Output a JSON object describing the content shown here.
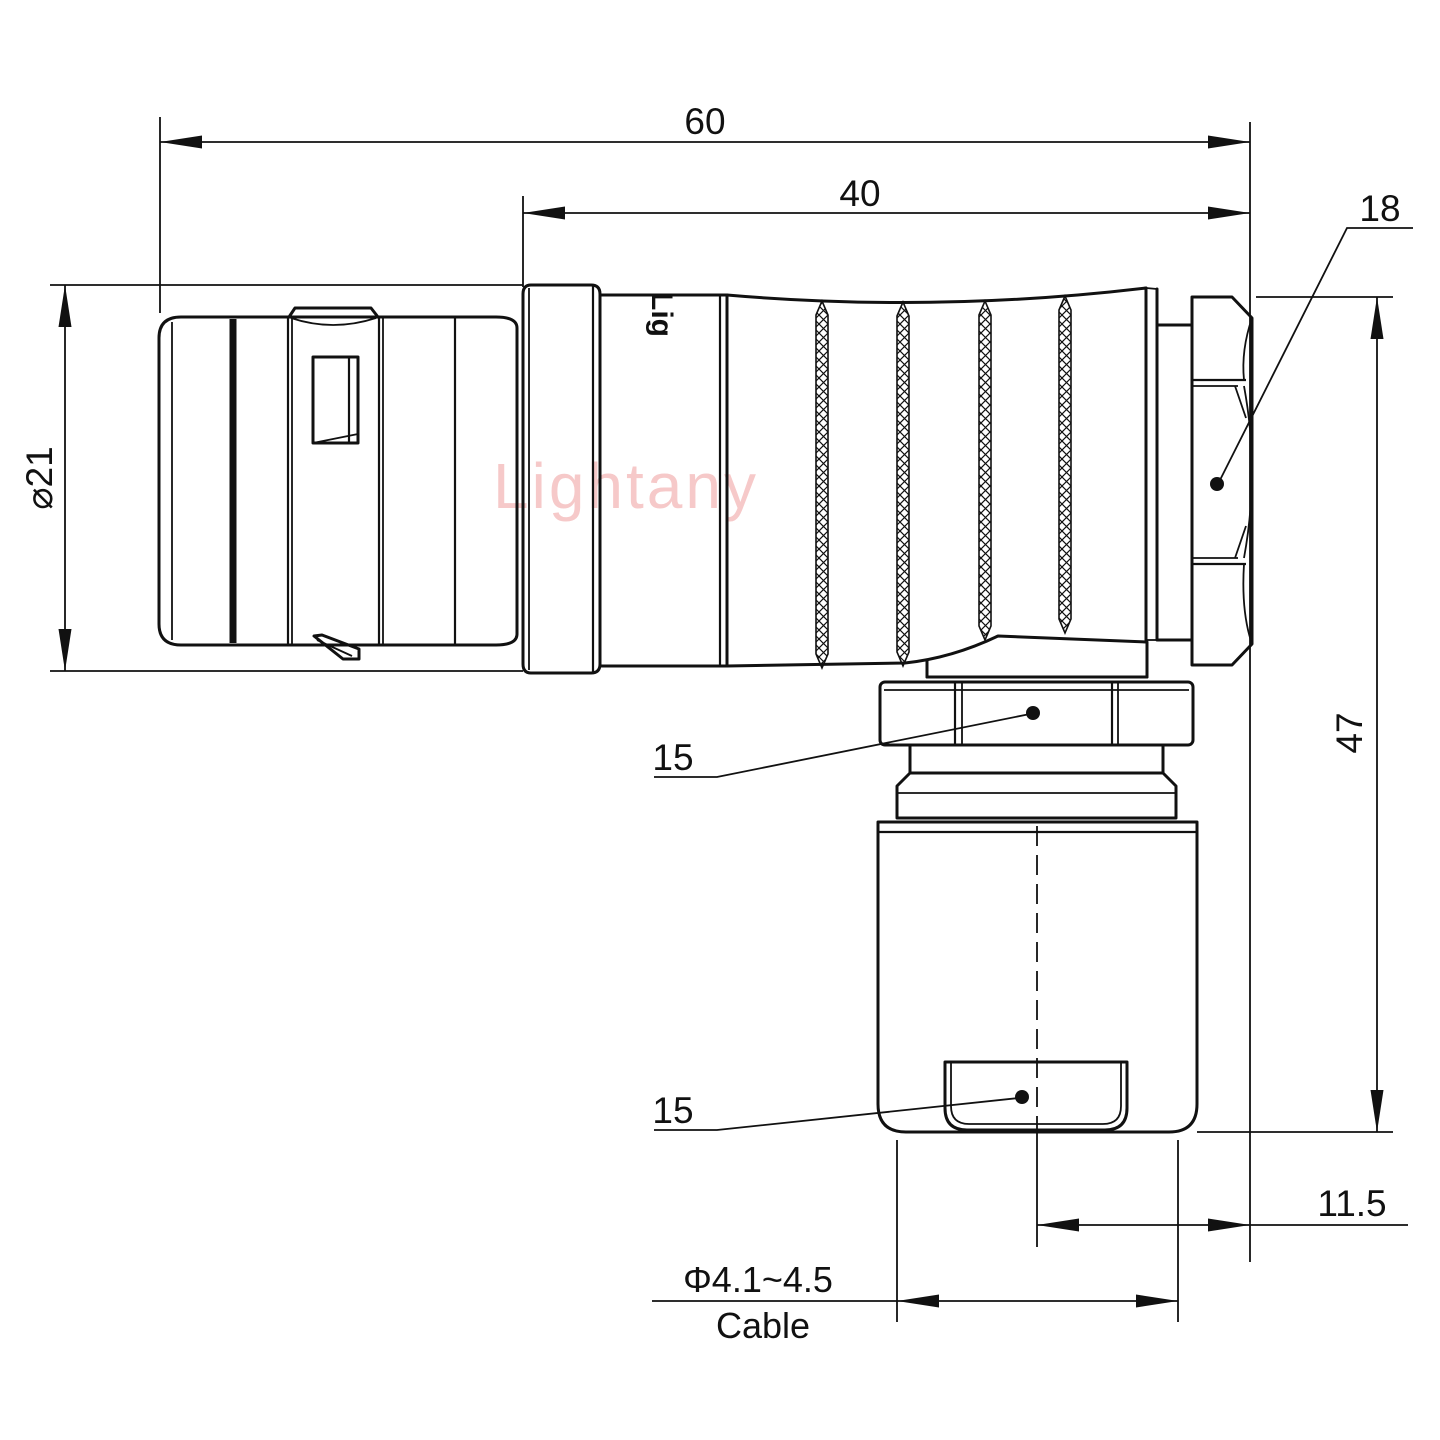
{
  "colors": {
    "background": "#ffffff",
    "line": "#111111",
    "watermark_pink": "#f4bcbc"
  },
  "watermark": "Lightany",
  "part_marking": "Lig",
  "dimensions": {
    "overall_length": "60",
    "rear_body_length": "40",
    "back_nut": "18",
    "front_diameter": "⌀21",
    "overall_height": "47",
    "elbow_nut": "15",
    "crimp_sleeve": "15",
    "axis_offset": "11.5",
    "cable_diameter": "Φ4.1~4.5",
    "cable_label": "Cable"
  }
}
